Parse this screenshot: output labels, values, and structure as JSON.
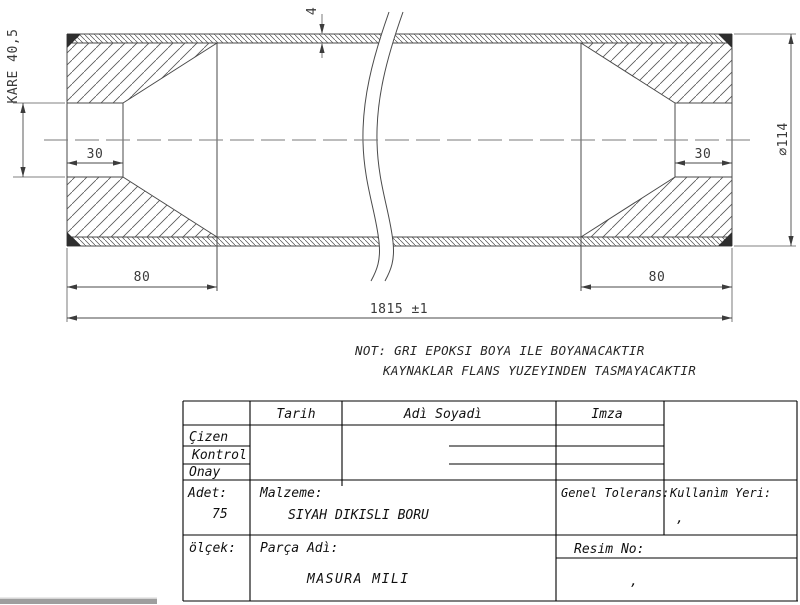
{
  "drawing": {
    "dimensions": {
      "square_end": "KARE 40,5",
      "wall_thickness": "4",
      "left_bore_length": "30",
      "right_bore_length": "30",
      "left_plug_length": "80",
      "right_plug_length": "80",
      "overall_length": "1815 ±1",
      "outer_diameter": "⌀114"
    },
    "notes": {
      "line1": "NOT: GRI EPOKSI BOYA ILE BOYANACAKTIR",
      "line2": "KAYNAKLAR FLANS YUZEYINDEN TASMAYACAKTIR"
    }
  },
  "title_block": {
    "col_headers": {
      "tarih": "Tarih",
      "adi_soyadi": "Adì Soyadì",
      "imza": "Imza"
    },
    "row_labels": {
      "cizen": "Çizen",
      "kontrol": "Kontrol",
      "onay": "Onay"
    },
    "adet": {
      "label": "Adet:",
      "value": "75"
    },
    "malzeme": {
      "label": "Malzeme:",
      "value": "SIYAH DIKISLI BORU"
    },
    "genel_tolerans": {
      "label": "Genel Tolerans:"
    },
    "kullanim_yeri": {
      "label": "Kullanìm Yeri:",
      "value": ","
    },
    "olcek": {
      "label": "ölçek:"
    },
    "parca_adi": {
      "label": "Parça Adì:",
      "value": "MASURA MILI"
    },
    "resim_no": {
      "label": "Resim No:",
      "value": ","
    }
  },
  "colors": {
    "drawing_line": "#4a4a4a",
    "table_line": "#000000",
    "background": "#ffffff",
    "scrollbar": "#9e9e9e"
  }
}
